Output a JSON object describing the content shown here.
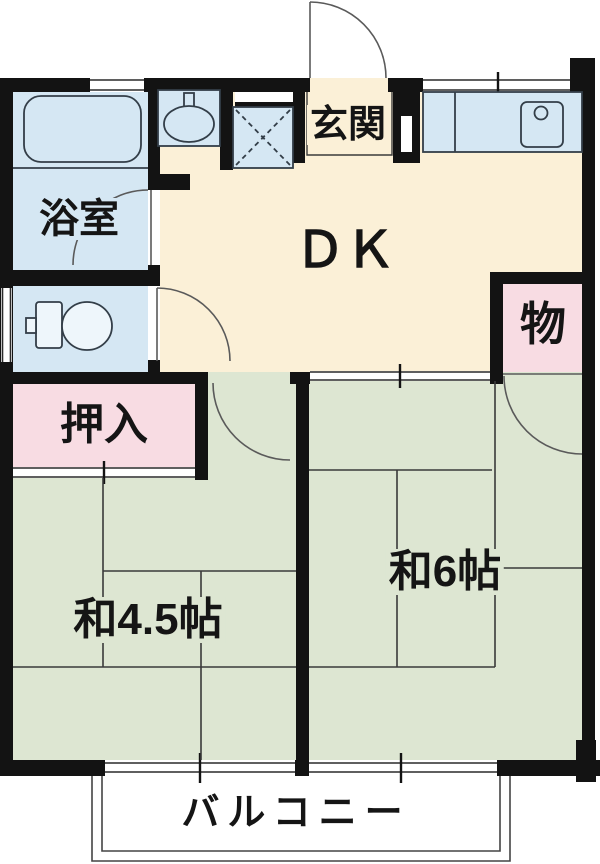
{
  "floor_plan": {
    "title": "1DK apartment floor plan",
    "labels": {
      "bathroom": "浴室",
      "entrance": "玄関",
      "dining_kitchen": "ＤＫ",
      "storage": "物",
      "closet": "押入",
      "japanese_room_45": "和4.5帖",
      "japanese_room_6": "和6帖",
      "balcony": "バルコニー"
    },
    "colors": {
      "wall": "#131313",
      "wet_area_blue": "#d5e7f3",
      "wood_floor_cream": "#fbf0d7",
      "tatami_green": "#dde6d2",
      "closet_pink": "#f8dce3",
      "thin_line": "#3a3a3a",
      "door_arc": "#5a5a5a"
    }
  }
}
